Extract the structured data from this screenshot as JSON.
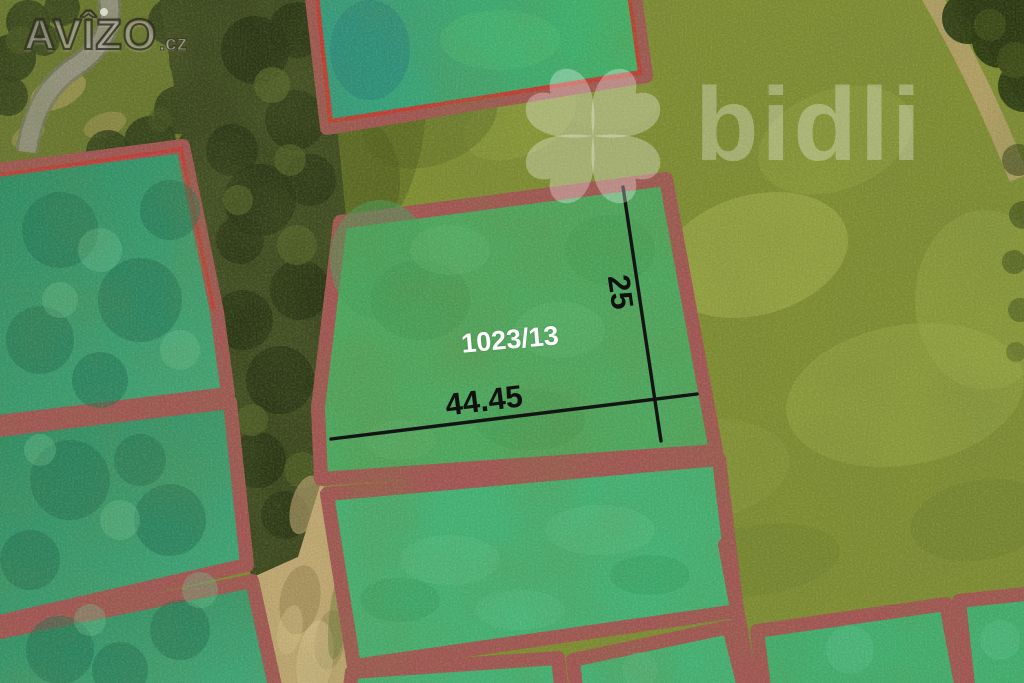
{
  "watermarks": {
    "avizo": {
      "text": "AVÎZO",
      "suffix": ".cz"
    },
    "bidli": {
      "text": "bidli",
      "icon": "bidli-flower-icon"
    }
  },
  "parcel": {
    "label": "1023/13"
  },
  "dimensions": {
    "width_m": "44.45",
    "depth_m": "25"
  },
  "colors": {
    "border_maroon": "#A25352",
    "border_red_accent": "#C9352B",
    "parcel_green": "#4BA75D",
    "parcel_bright_green": "#41B274",
    "parcel_teal": "#379B6D",
    "field_olive": "#7E8C30",
    "dirt_path_tan": "#C0A771",
    "dimension_line": "#141414",
    "parcel_label_text": "#FFFFFF"
  }
}
